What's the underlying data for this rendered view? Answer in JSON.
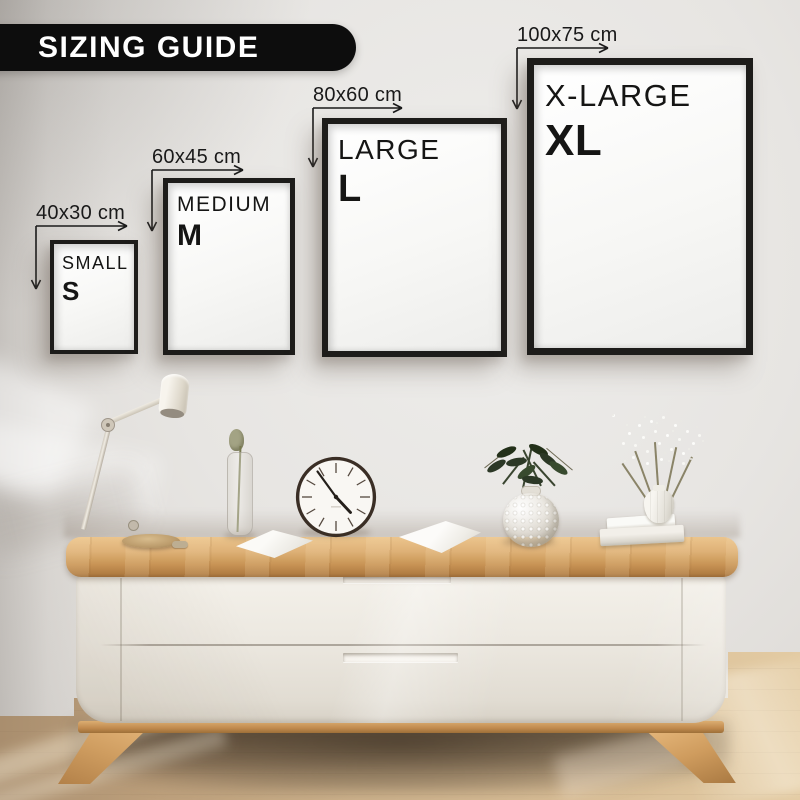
{
  "banner": {
    "title": "SIZING GUIDE"
  },
  "frames": [
    {
      "dimension_label": "40x30 cm",
      "size_name": "SMALL",
      "size_code": "S"
    },
    {
      "dimension_label": "60x45 cm",
      "size_name": "MEDIUM",
      "size_code": "M"
    },
    {
      "dimension_label": "80x60 cm",
      "size_name": "LARGE",
      "size_code": "L"
    },
    {
      "dimension_label": "100x75 cm",
      "size_name": "X-LARGE",
      "size_code": "XL"
    }
  ],
  "colors": {
    "banner_bg": "#0d0d0d",
    "banner_text": "#ffffff",
    "frame_border": "#1d1c1a",
    "frame_mat": "#f8f8f6",
    "annotation": "#191919",
    "wall": "#e3e1de",
    "wood_top": "#d2a263",
    "cabinet_body": "#ece8e0",
    "floor": "#ccb18b"
  }
}
